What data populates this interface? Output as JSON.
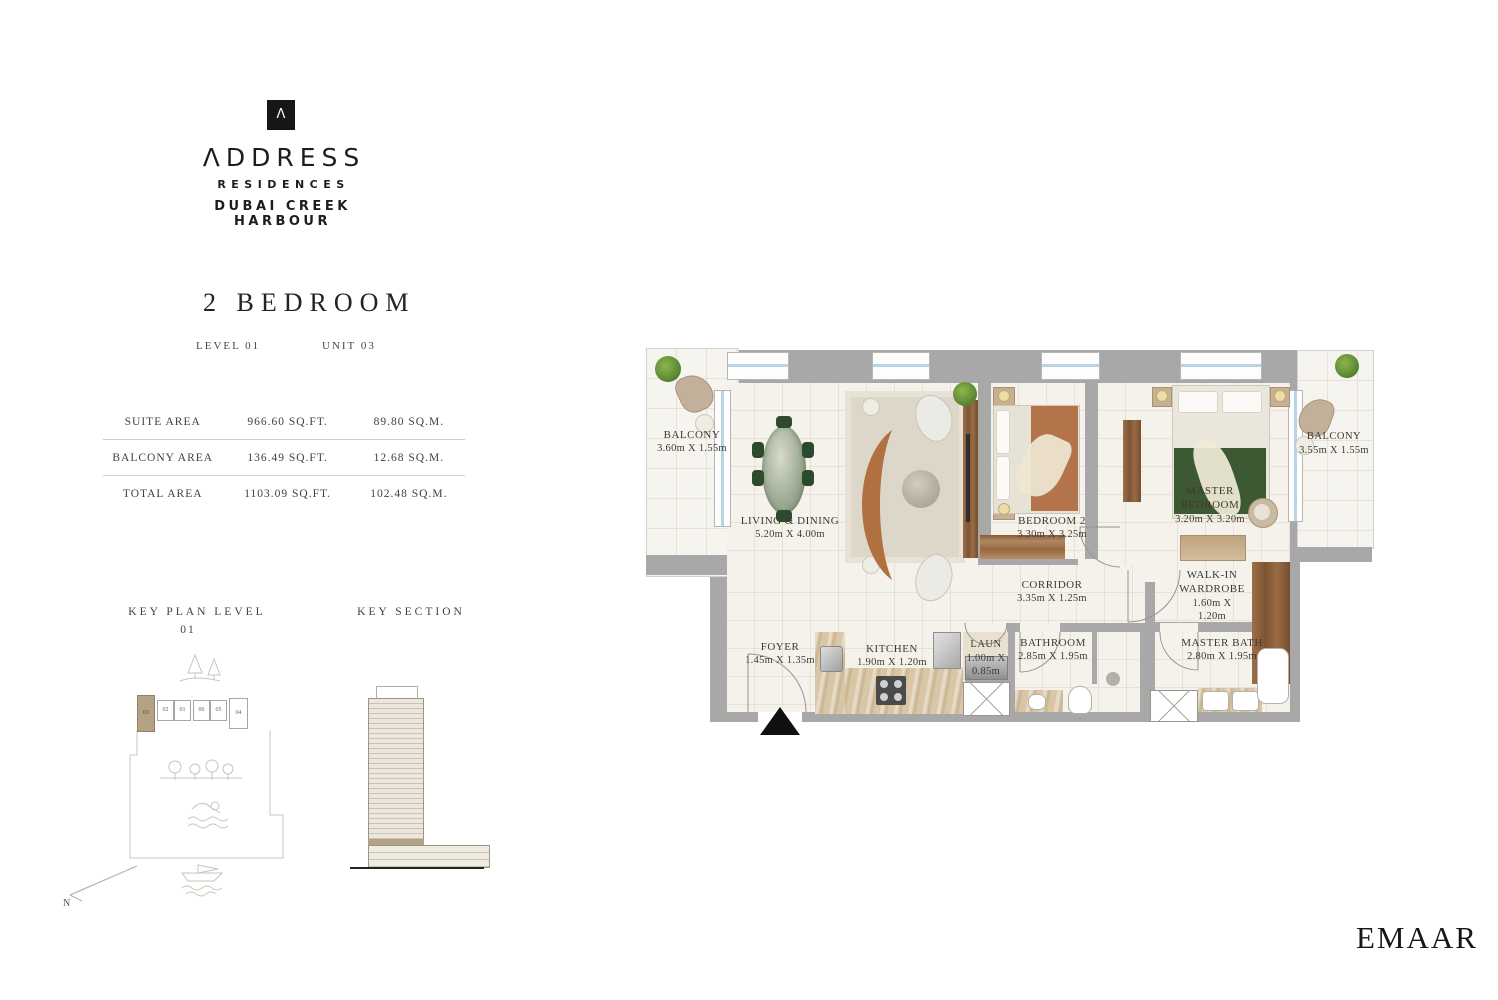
{
  "brand": {
    "symbol": "Λ",
    "wordmark": "ΛDDRESS",
    "line1": "RESIDENCES",
    "line2": "DUBAI CREEK HARBOUR"
  },
  "unit": {
    "title": "2 BEDROOM",
    "level_label": "LEVEL 01",
    "unit_label": "UNIT 03"
  },
  "areas": {
    "rows": [
      {
        "label": "SUITE AREA",
        "sqft": "966.60 SQ.FT.",
        "sqm": "89.80 SQ.M."
      },
      {
        "label": "BALCONY AREA",
        "sqft": "136.49 SQ.FT.",
        "sqm": "12.68 SQ.M."
      },
      {
        "label": "TOTAL AREA",
        "sqft": "1103.09 SQ.FT.",
        "sqm": "102.48 SQ.M."
      }
    ]
  },
  "key_plan": {
    "title": "KEY PLAN LEVEL",
    "number": "01",
    "units": [
      "03",
      "02",
      "01",
      "06",
      "05",
      "04"
    ],
    "highlighted_unit": "03"
  },
  "key_section": {
    "title": "KEY SECTION"
  },
  "compass": {
    "label": "N"
  },
  "floorplan": {
    "rooms": [
      {
        "id": "balcony-left",
        "name": "BALCONY",
        "dims": "3.60m X 1.55m"
      },
      {
        "id": "living-dining",
        "name": "LIVING & DINING",
        "dims": "5.20m X 4.00m"
      },
      {
        "id": "bedroom-2",
        "name": "BEDROOM 2",
        "dims": "3.30m X 3.25m"
      },
      {
        "id": "master-bedroom",
        "name": "MASTER BEDROOM",
        "dims": "3.20m X 3.20m"
      },
      {
        "id": "balcony-right",
        "name": "BALCONY",
        "dims": "3.55m X 1.55m"
      },
      {
        "id": "corridor",
        "name": "CORRIDOR",
        "dims": "3.35m X 1.25m"
      },
      {
        "id": "walkin-wardrobe",
        "name": "WALK-IN WARDROBE",
        "dims": "1.60m X 1.20m"
      },
      {
        "id": "foyer",
        "name": "FOYER",
        "dims": "1.45m X 1.35m"
      },
      {
        "id": "kitchen",
        "name": "KITCHEN",
        "dims": "1.90m X 1.20m"
      },
      {
        "id": "laundry",
        "name": "LAUN",
        "dims": "1.00m X 0.85m"
      },
      {
        "id": "bathroom",
        "name": "BATHROOM",
        "dims": "2.85m X 1.95m"
      },
      {
        "id": "master-bath",
        "name": "MASTER BATH",
        "dims": "2.80m X 1.95m"
      }
    ]
  },
  "footer": {
    "logo": "EMAAR"
  },
  "colors": {
    "wall": "#a8a8a8",
    "floor": "#f5f2ec",
    "accent_tan": "#b3a284",
    "window_blue": "#b9d3e6",
    "wood": "#8a5c38",
    "sofa": "#b0703f",
    "bed_green": "#3d5933",
    "ink": "#3e3933"
  }
}
